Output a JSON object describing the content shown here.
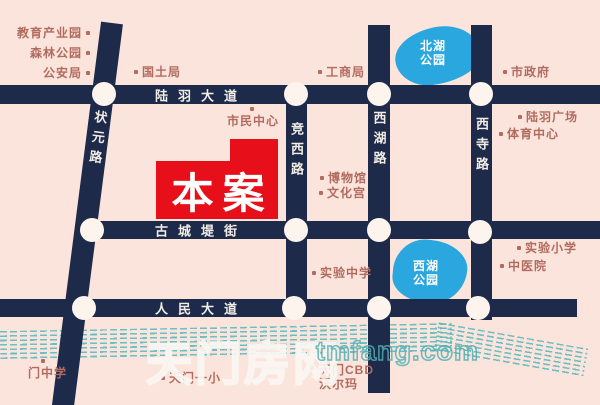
{
  "map": {
    "site_label": "本案",
    "watermark": {
      "cn": "天门房网",
      "en": "tmfang.com"
    },
    "roads": {
      "luyu": {
        "name": "陆羽大道"
      },
      "gucheng": {
        "name": "古城堤街"
      },
      "renmin": {
        "name": "人民大道"
      },
      "zhuangyuan": {
        "name": "状元路"
      },
      "jingxi": {
        "name": "竞西路"
      },
      "xihu": {
        "name": "西湖路"
      },
      "xisi": {
        "name": "西寺路"
      }
    },
    "lakes": {
      "north": {
        "line1": "北湖",
        "line2": "公园"
      },
      "west": {
        "line1": "西湖",
        "line2": "公园"
      }
    },
    "pois": {
      "jiaoyu": "教育产业园",
      "senlin": "森林公园",
      "gongan": "公安局",
      "guotu": "国土局",
      "gongshang": "工商局",
      "shimin": "市民中心",
      "bowuguan": "博物馆",
      "wenhua": "文化宫",
      "shizhengfu": "市政府",
      "luyu_plaza": "陆羽广场",
      "tiyu": "体育中心",
      "shiyan_middle": "实验中学",
      "shiyan_primary": "实验小学",
      "zhongyi": "中医院",
      "men_middle": "门中学",
      "tianmen_primary": "天门一小",
      "cbd_line1": "天门CBD",
      "cbd_line2": "沃尔玛"
    },
    "colors": {
      "background": "#fae4dc",
      "road": "#1d2a4a",
      "site_red": "#e60f1a",
      "lake_blue": "#2aa7de",
      "label": "#b26b5f",
      "river": "#5fb9be",
      "road_text": "#f1ece6"
    }
  }
}
